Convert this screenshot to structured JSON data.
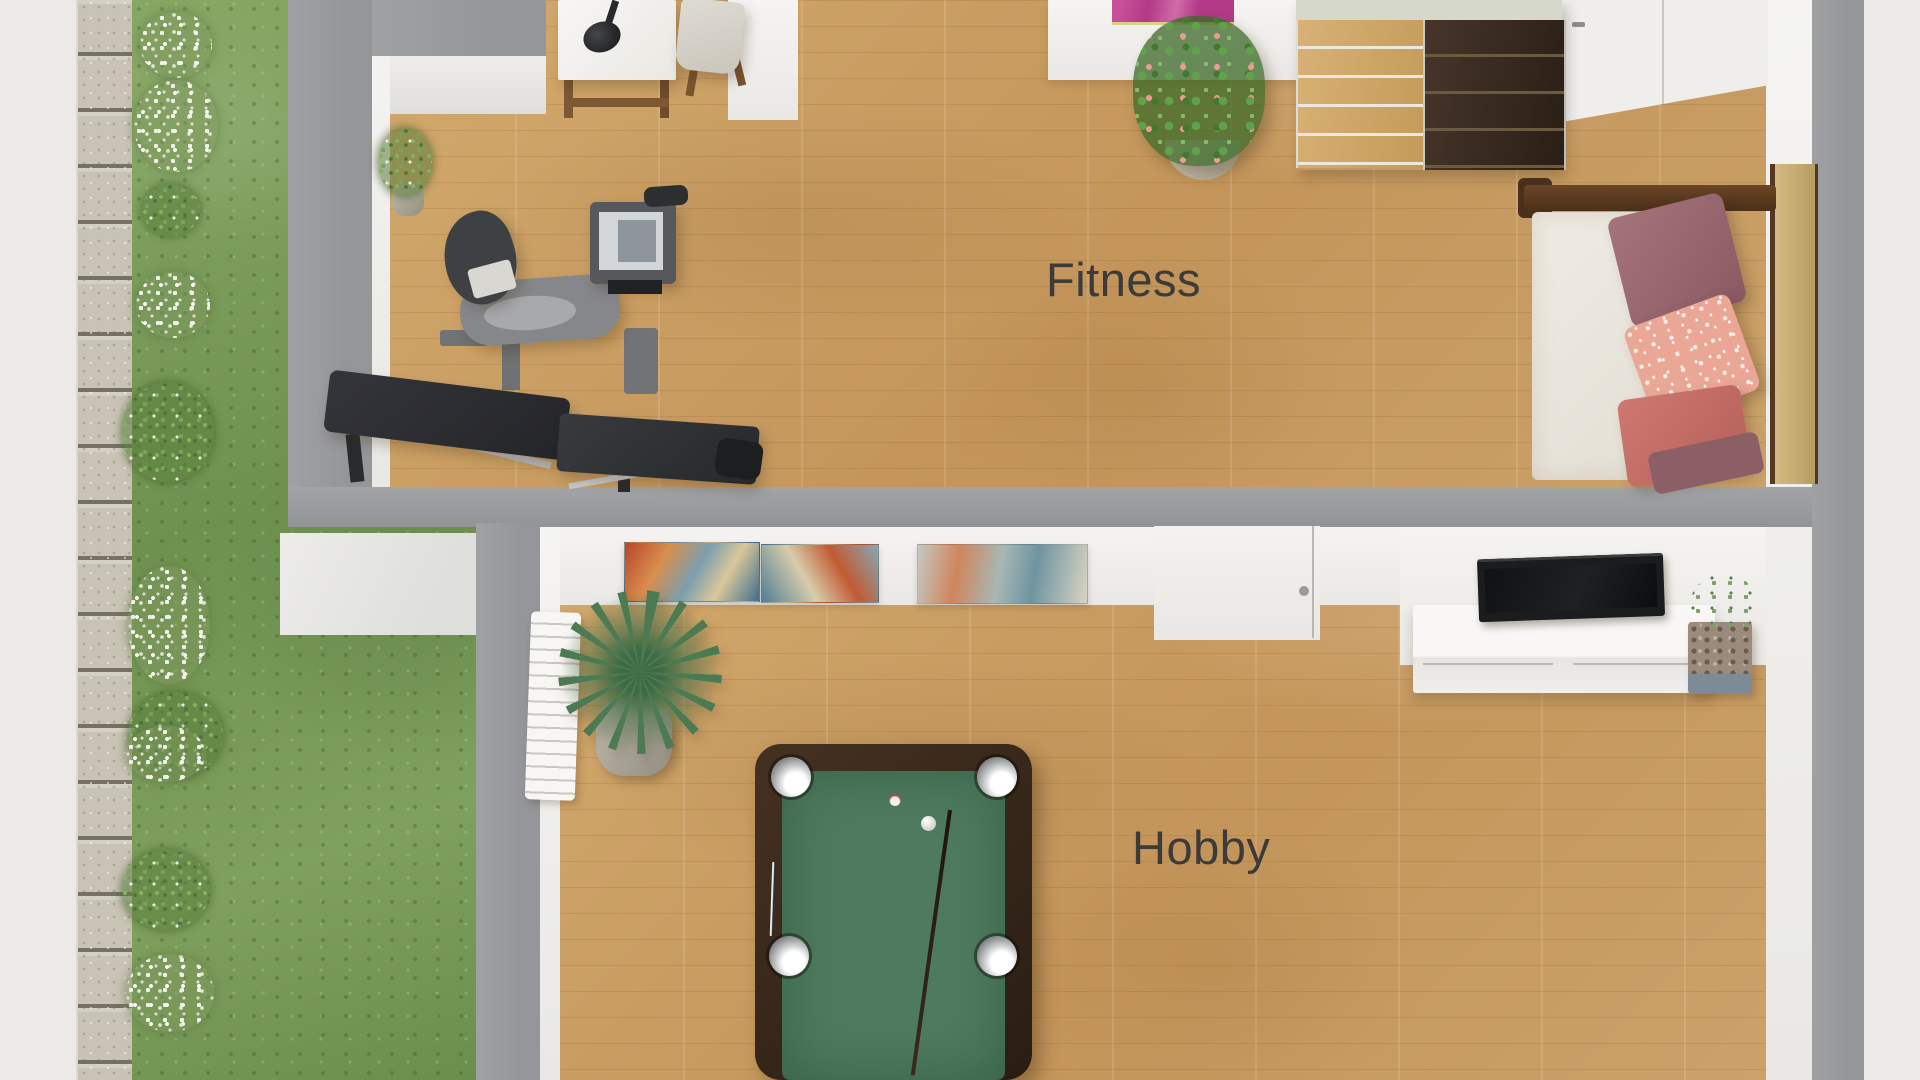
{
  "meta": {
    "title": "3D floor plan render",
    "view": "top-down",
    "style": "photoreal"
  },
  "rooms": [
    {
      "id": "fitness",
      "label": "Fitness",
      "furniture": [
        "desk",
        "desk-lamp",
        "chair",
        "potted-plant",
        "recumbent-exercise-bike",
        "weight-bench",
        "pink-wall-art",
        "flowering-plant",
        "drawer-dresser",
        "entry-door",
        "daybed-with-pillows"
      ]
    },
    {
      "id": "hobby",
      "label": "Hobby",
      "furniture": [
        "radiator",
        "yucca-plant",
        "abstract-wall-art-1",
        "abstract-wall-art-2",
        "abstract-wall-art-3",
        "interior-door",
        "pool-table",
        "pool-cue",
        "pool-balls",
        "wall-tv",
        "tv-sideboard",
        "small-potted-plant"
      ]
    }
  ],
  "exterior": {
    "elements": [
      "paved-area",
      "stone-path",
      "lawn",
      "white-flower-shrubs"
    ]
  },
  "palette": {
    "wall_gray": "#9a9c9e",
    "interior_white": "#f2f1ee",
    "wood_floor": "#c99f63",
    "grass": "#7b9b58",
    "stone_path": "#c9c3b5",
    "pool_felt": "#4e7b60",
    "pool_frame": "#32241a",
    "daybed_wood": "#57391f",
    "dresser_dark": "#35281c",
    "dresser_light": "#cfa766",
    "pink_art": "#bc3f8e",
    "label_text": "#3b3b3b"
  }
}
